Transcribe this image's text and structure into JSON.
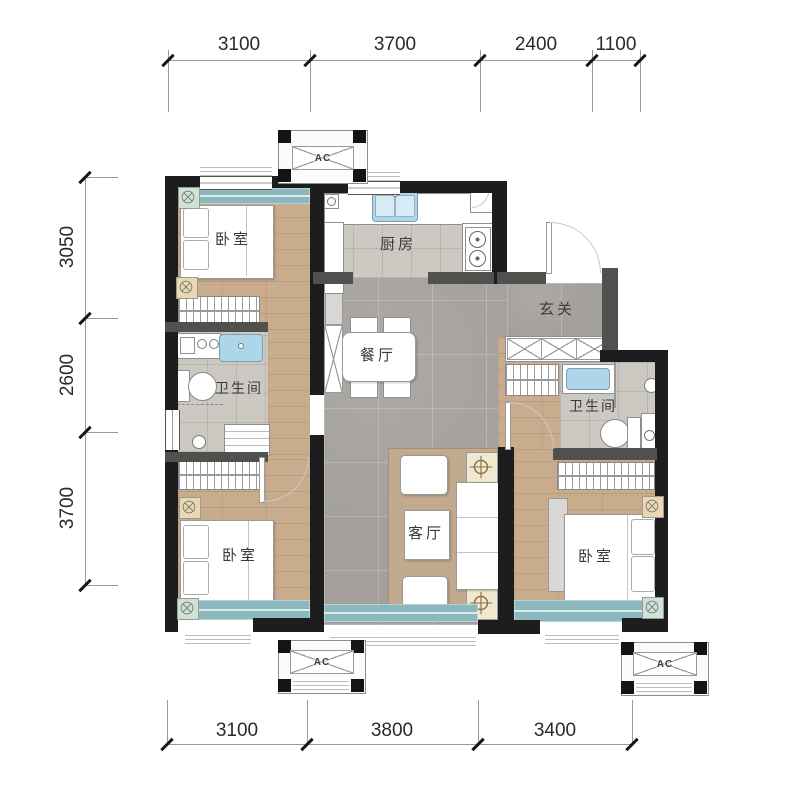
{
  "dimensions": {
    "top": [
      "3100",
      "3700",
      "2400",
      "1100"
    ],
    "left": [
      "3050",
      "2600",
      "3700"
    ],
    "bottom": [
      "3100",
      "3800",
      "3400"
    ]
  },
  "rooms": {
    "bedroom_top_left": "卧室",
    "kitchen": "厨房",
    "entry": "玄关",
    "dining": "餐厅",
    "bath_left": "卫生间",
    "bath_right": "卫生间",
    "living": "客厅",
    "bedroom_bottom_left": "卧室",
    "bedroom_bottom_right": "卧室"
  },
  "ac_units": {
    "top": "AC",
    "bottom_left": "AC",
    "bottom_right": "AC"
  },
  "colors": {
    "wall": "#1d1d1f",
    "wall_secondary": "#50504f",
    "window_glass": "#8ab8bc",
    "wood_floor": "#c9ac8e",
    "tile_floor": "#a3a09c",
    "bath_tile": "#ccc9c2",
    "rug": "#c2aa8e"
  }
}
